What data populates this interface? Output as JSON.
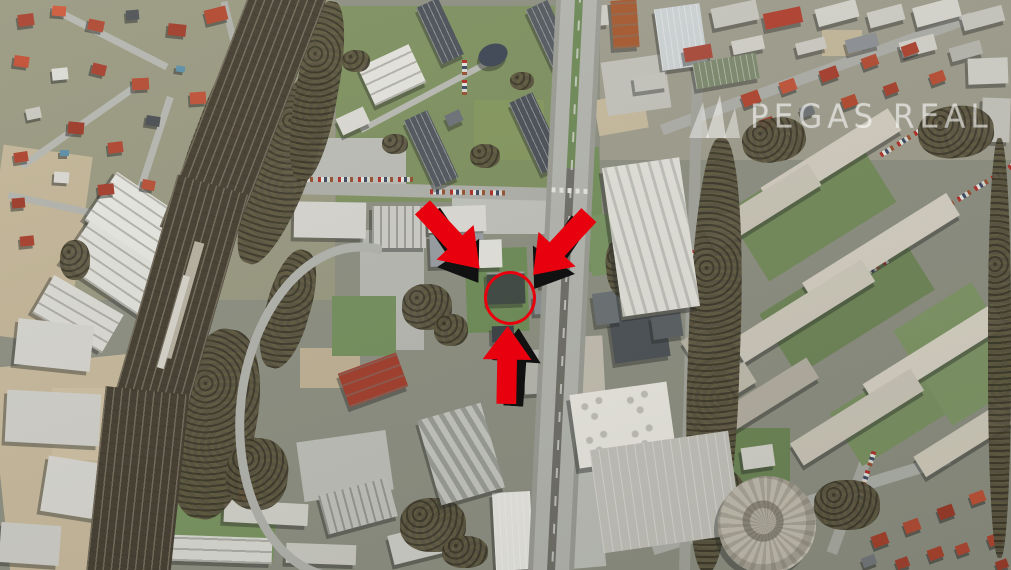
{
  "app": {
    "type": "aerial-satellite-photo",
    "description": "Satellite aerial photograph of an urban district: suburban houses and a curving multi-track railway corridor on the left, industrial halls in the center, a main boulevard running vertically, panel apartment blocks and a circular building on the right"
  },
  "watermark": {
    "text": "PEGAS REAL",
    "logo_icon": "pegasus-wing-icon",
    "text_color": "rgba(255,255,255,0.46)"
  },
  "annotations": {
    "highlight_color": "#e8000e",
    "shadow_color": "#111111",
    "arrows": [
      {
        "name": "arrow-top-left",
        "points": "down-right toward highlighted building"
      },
      {
        "name": "arrow-top-right",
        "points": "down-left toward highlighted building"
      },
      {
        "name": "arrow-bottom",
        "points": "up toward highlighted building"
      }
    ],
    "circle": {
      "shape": "ellipse-outline",
      "color": "#e8000e",
      "marks": "small dark flat-roofed building beside the main road"
    }
  }
}
